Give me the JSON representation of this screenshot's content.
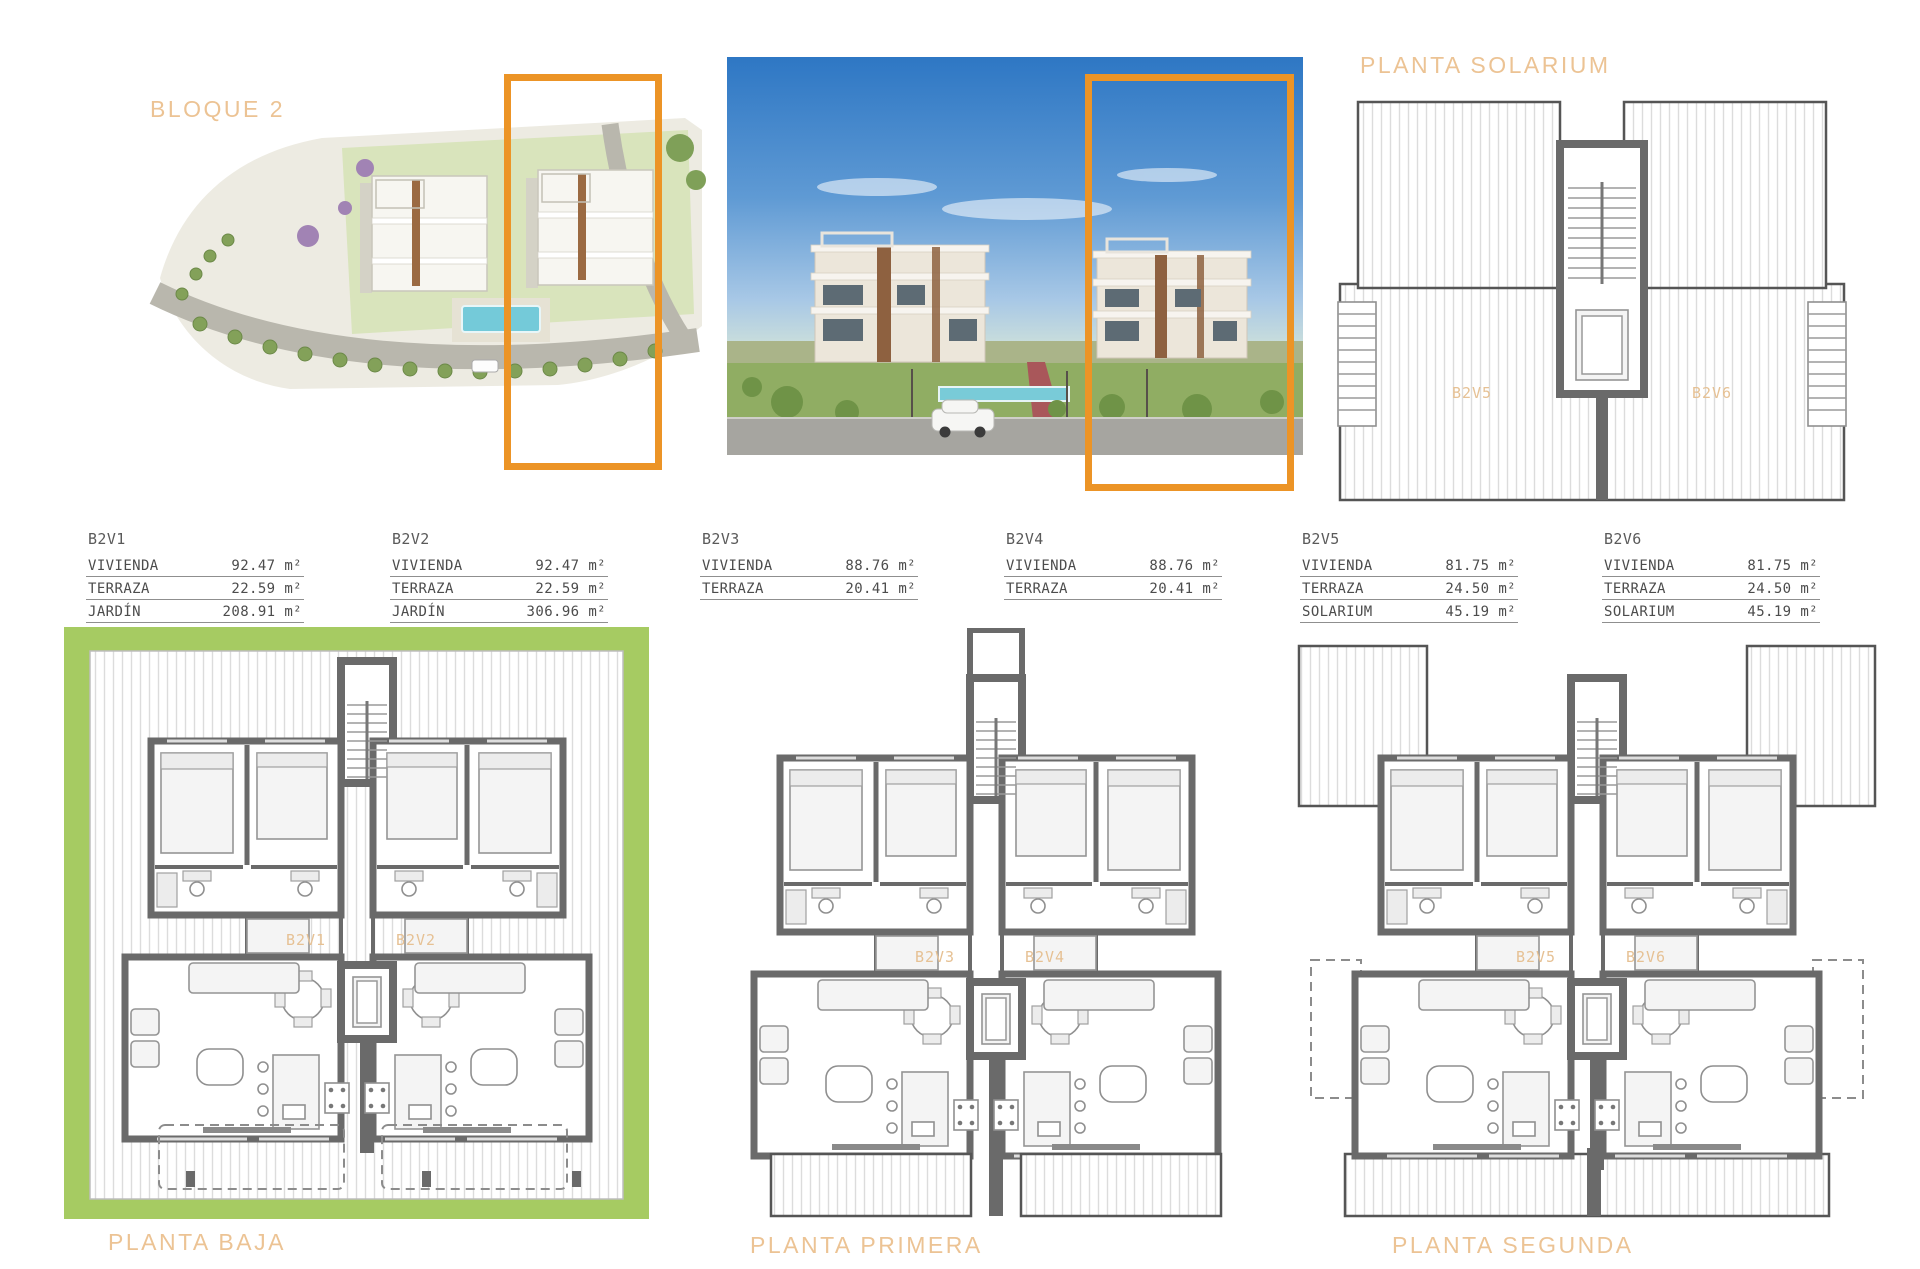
{
  "colors": {
    "accent_orange": "#ec9426",
    "heading_tan": "#ecc394",
    "garden_green": "#a6cb62",
    "wall_gray": "#6a6a6a"
  },
  "titles": {
    "block": "BLOQUE 2",
    "solarium": "PLANTA SOLARIUM",
    "baja": "PLANTA BAJA",
    "primera": "PLANTA PRIMERA",
    "segunda": "PLANTA SEGUNDA"
  },
  "unit_tables": [
    {
      "id": "B2V1",
      "rows": [
        [
          "VIVIENDA",
          "92.47 m²"
        ],
        [
          "TERRAZA",
          "22.59 m²"
        ],
        [
          "JARDÍN",
          "208.91 m²"
        ]
      ]
    },
    {
      "id": "B2V2",
      "rows": [
        [
          "VIVIENDA",
          "92.47 m²"
        ],
        [
          "TERRAZA",
          "22.59 m²"
        ],
        [
          "JARDÍN",
          "306.96 m²"
        ]
      ]
    },
    {
      "id": "B2V3",
      "rows": [
        [
          "VIVIENDA",
          "88.76 m²"
        ],
        [
          "TERRAZA",
          "20.41 m²"
        ]
      ]
    },
    {
      "id": "B2V4",
      "rows": [
        [
          "VIVIENDA",
          "88.76 m²"
        ],
        [
          "TERRAZA",
          "20.41 m²"
        ]
      ]
    },
    {
      "id": "B2V5",
      "rows": [
        [
          "VIVIENDA",
          "81.75 m²"
        ],
        [
          "TERRAZA",
          "24.50 m²"
        ],
        [
          "SOLARIUM",
          "45.19 m²"
        ]
      ]
    },
    {
      "id": "B2V6",
      "rows": [
        [
          "VIVIENDA",
          "81.75 m²"
        ],
        [
          "TERRAZA",
          "24.50 m²"
        ],
        [
          "SOLARIUM",
          "45.19 m²"
        ]
      ]
    }
  ],
  "plan_labels": {
    "baja_left": "B2V1",
    "baja_right": "B2V2",
    "primera_left": "B2V3",
    "primera_right": "B2V4",
    "segunda_left": "B2V5",
    "segunda_right": "B2V6",
    "solarium_left": "B2V5",
    "solarium_right": "B2V6"
  }
}
